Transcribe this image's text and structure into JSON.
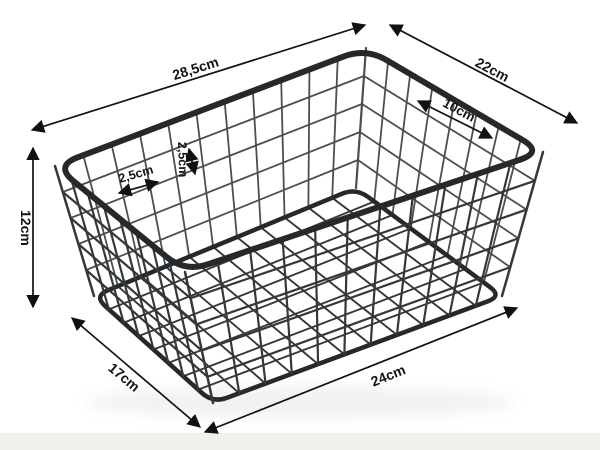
{
  "diagram": {
    "subject": "black-wire-mesh-storage-basket",
    "unit": "cm",
    "dimensions": {
      "rim_length": "28,5cm",
      "rim_width": "22cm",
      "wire_span": "10cm",
      "mesh_cell_width": "2,5cm",
      "mesh_cell_height": "2,5cm",
      "height": "12cm",
      "base_width": "17cm",
      "base_length": "24cm"
    },
    "colors": {
      "wire": "#34383a",
      "wire_inner": "#4b4f51",
      "rim": "#26292b",
      "dimension_lines": "#111111",
      "background": "#ffffff",
      "floor_strip": "#f0f1ed"
    }
  }
}
